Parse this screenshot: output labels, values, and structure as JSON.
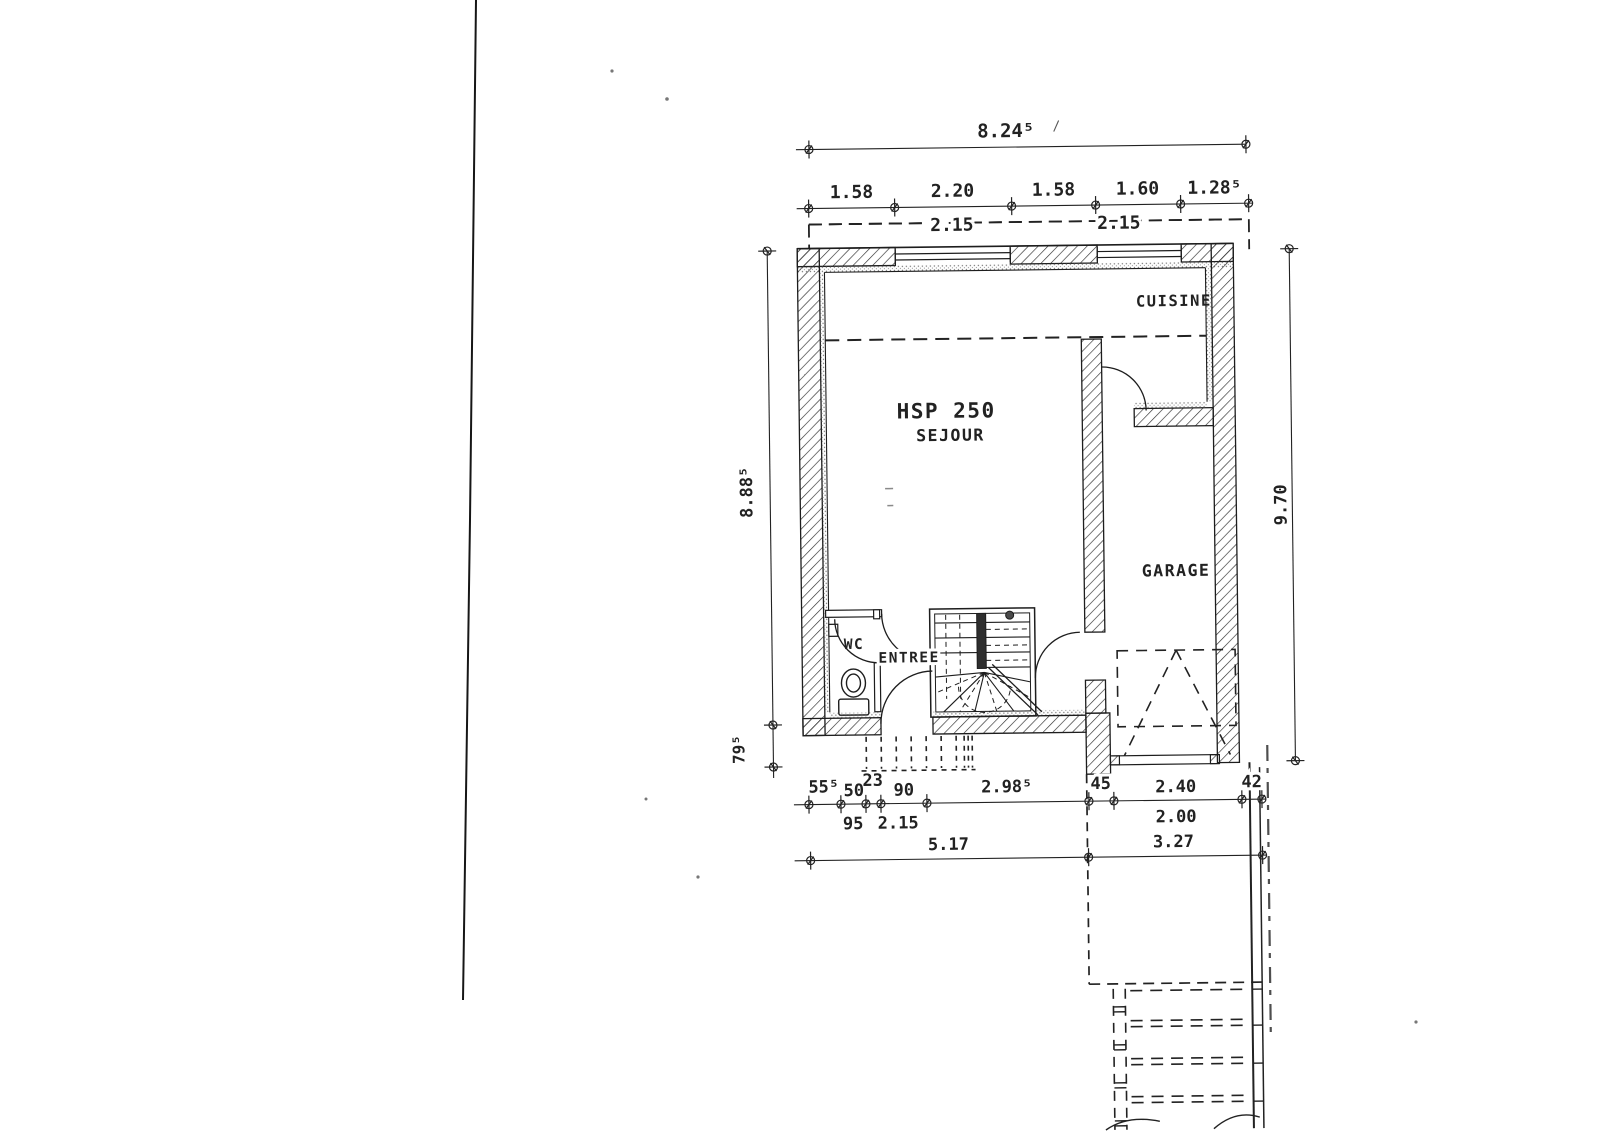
{
  "page": {
    "paper_color": "#ffffff",
    "ink_color": "#222222",
    "description": "scanned ground-floor architectural plan"
  },
  "rooms": {
    "cuisine": "CUISINE",
    "hsp": "HSP 250",
    "sejour": "SEJOUR",
    "garage": "GARAGE",
    "wc": "WC",
    "entree": "ENTREE"
  },
  "dimensions": {
    "top_total": "8.24⁵",
    "top_segments": [
      "1.58",
      "2.20",
      "1.58",
      "1.60",
      "1.28⁵"
    ],
    "top_openings": [
      "2.15",
      "2.15"
    ],
    "left_total": "8.88⁵",
    "left_offset": "79⁵",
    "right_total": "9.70",
    "bottom_upper": [
      "55⁵",
      "50",
      "23",
      "90",
      "2.98⁵",
      "45",
      "2.40",
      "42"
    ],
    "bottom_lower": [
      "95",
      "2.15",
      "2.00"
    ],
    "bottom_totals": [
      "5.17",
      "3.27"
    ]
  }
}
